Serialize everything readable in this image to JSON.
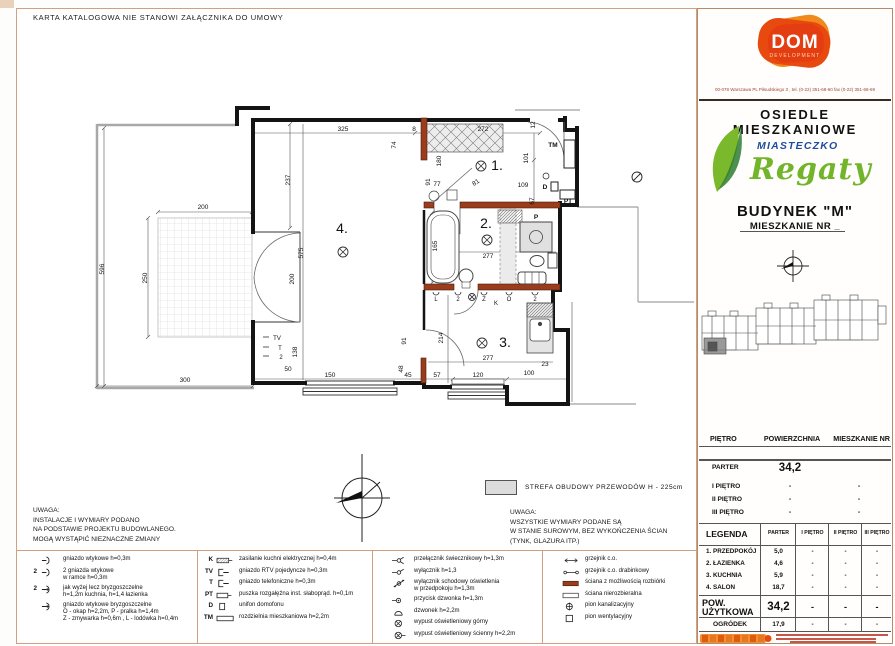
{
  "sheet": {
    "disclaimer": "KARTA  KATALOGOWA  NIE STANOWI  ZAŁĄCZNIKA DO UMOWY",
    "strefa_label": "STREFA  OBUDOWY  PRZEWODÓW  H - 225cm",
    "note_left": {
      "title": "UWAGA:",
      "lines": [
        "INSTALACJE I WYMIARY PODANO",
        "NA PODSTAWIE PROJEKTU BUDOWLANEGO.",
        "MOGĄ WYSTĄPIĆ NIEZNACZNE ZMIANY"
      ]
    },
    "note_right": {
      "title": "UWAGA:",
      "lines": [
        "WSZYSTKIE WYMIARY PODANE SĄ",
        "W STANIE SUROWYM, BEZ WYKOŃCZENIA ŚCIAN",
        "(TYNK, GLAZURA ITP.)"
      ]
    }
  },
  "plan": {
    "texts": [
      {
        "t": "325",
        "x": 343,
        "y": 131
      },
      {
        "t": "8",
        "x": 414,
        "y": 131
      },
      {
        "t": "74",
        "x": 396,
        "y": 145,
        "r": -90
      },
      {
        "t": "272",
        "x": 483,
        "y": 131
      },
      {
        "t": "12",
        "x": 535,
        "y": 125,
        "r": -90
      },
      {
        "t": "180",
        "x": 441,
        "y": 161,
        "r": -90
      },
      {
        "t": "101",
        "x": 528,
        "y": 158,
        "r": -90
      },
      {
        "t": "91",
        "x": 430,
        "y": 182,
        "r": -90
      },
      {
        "t": "77",
        "x": 437,
        "y": 186
      },
      {
        "t": "81",
        "x": 477,
        "y": 184,
        "r": -35
      },
      {
        "t": "109",
        "x": 523,
        "y": 187
      },
      {
        "t": "67",
        "x": 534,
        "y": 201,
        "r": -90
      },
      {
        "t": "237",
        "x": 290,
        "y": 180,
        "r": -90
      },
      {
        "t": "575",
        "x": 303,
        "y": 253,
        "r": -90
      },
      {
        "t": "200",
        "x": 294,
        "y": 279,
        "r": -90
      },
      {
        "t": "200",
        "x": 203,
        "y": 209
      },
      {
        "t": "250",
        "x": 147,
        "y": 278,
        "r": -90
      },
      {
        "t": "596",
        "x": 104,
        "y": 269,
        "r": -90
      },
      {
        "t": "300",
        "x": 185,
        "y": 382
      },
      {
        "t": "165",
        "x": 437,
        "y": 246,
        "r": -90
      },
      {
        "t": "277",
        "x": 488,
        "y": 258
      },
      {
        "t": "214",
        "x": 443,
        "y": 338,
        "r": -90
      },
      {
        "t": "91",
        "x": 406,
        "y": 341,
        "r": -90
      },
      {
        "t": "277",
        "x": 488,
        "y": 360
      },
      {
        "t": "48",
        "x": 403,
        "y": 369,
        "r": -90
      },
      {
        "t": "57",
        "x": 437,
        "y": 377
      },
      {
        "t": "120",
        "x": 478,
        "y": 377
      },
      {
        "t": "100",
        "x": 529,
        "y": 375
      },
      {
        "t": "23",
        "x": 545,
        "y": 366
      },
      {
        "t": "150",
        "x": 330,
        "y": 377
      },
      {
        "t": "45",
        "x": 408,
        "y": 377
      },
      {
        "t": "138",
        "x": 297,
        "y": 352,
        "r": -90
      },
      {
        "t": "50",
        "x": 288,
        "y": 371
      },
      {
        "t": "TM",
        "x": 553,
        "y": 147,
        "b": 1
      },
      {
        "t": "D",
        "x": 545,
        "y": 189,
        "b": 1
      },
      {
        "t": "PT",
        "x": 568,
        "y": 203,
        "b": 1
      },
      {
        "t": "P",
        "x": 536,
        "y": 219,
        "b": 1
      },
      {
        "t": "TV",
        "x": 277,
        "y": 340,
        "size": 6
      },
      {
        "t": "T",
        "x": 280,
        "y": 350,
        "size": 6
      },
      {
        "t": "2",
        "x": 281,
        "y": 359,
        "size": 6
      },
      {
        "t": "L",
        "x": 436,
        "y": 301,
        "size": 6
      },
      {
        "t": "2",
        "x": 458,
        "y": 301,
        "size": 6
      },
      {
        "t": "Z",
        "x": 484,
        "y": 301,
        "size": 6
      },
      {
        "t": "K",
        "x": 496,
        "y": 305,
        "size": 6
      },
      {
        "t": "O",
        "x": 509,
        "y": 301,
        "size": 6
      },
      {
        "t": "2",
        "x": 535,
        "y": 301,
        "size": 6
      },
      {
        "t": "4.",
        "x": 342,
        "y": 233,
        "size": 14,
        "n": "room-number-salon"
      },
      {
        "t": "1.",
        "x": 497,
        "y": 170,
        "size": 14,
        "n": "room-number-przedpokoj"
      },
      {
        "t": "2.",
        "x": 486,
        "y": 228,
        "size": 14,
        "n": "room-number-lazienka"
      },
      {
        "t": "3.",
        "x": 505,
        "y": 347,
        "size": 14,
        "n": "room-number-kuchnia"
      }
    ],
    "lights": [
      [
        343,
        252,
        5
      ],
      [
        481,
        166,
        5
      ],
      [
        487,
        240,
        5
      ],
      [
        482,
        343,
        5
      ],
      [
        472,
        297,
        3.5
      ]
    ]
  },
  "legend": {
    "col1": [
      {
        "icon": "socket",
        "pre": "",
        "lines": [
          "gniazdo wtykowe h=0,3m"
        ]
      },
      {
        "icon": "socket",
        "pre": "2",
        "lines": [
          "2 gniazda wtykowe",
          "w ramce h=0,3m"
        ]
      },
      {
        "icon": "socket-splash",
        "pre": "2",
        "lines": [
          "jak wyżej lecz bryzgoszczelne",
          "h=1,2m kuchnia, h=1,4 łazienka"
        ]
      },
      {
        "icon": "socket-splash",
        "pre": "",
        "lines": [
          "gniazdo wtykowe bryzgoszczelne",
          "O - okap h=2,2m, P - pralka h=1,4m",
          "Z - zmywarka h=0,6m , L - lodówka h=0,4m"
        ]
      }
    ],
    "col2": [
      {
        "icon": "kbox",
        "pre": "K",
        "lines": [
          "zasilanie kuchni elektrycznej h=0,4m"
        ]
      },
      {
        "icon": "jack",
        "pre": "TV",
        "lines": [
          "gniazdo RTV pojedyncze h=0,3m"
        ]
      },
      {
        "icon": "jack",
        "pre": "T",
        "lines": [
          "gniazdo telefoniczne h=0,3m"
        ]
      },
      {
        "icon": "ptbox",
        "pre": "PT",
        "lines": [
          "puszka rozgałęźna inst. słaboprąd. h=0,1m"
        ]
      },
      {
        "icon": "dbox",
        "pre": "D",
        "lines": [
          "unifon domofonu"
        ]
      },
      {
        "icon": "tmbox",
        "pre": "TM",
        "lines": [
          "rozdzielnia mieszkaniowa h=2,2m"
        ]
      }
    ],
    "col3": [
      {
        "icon": "sw-double",
        "pre": "",
        "lines": [
          "przełącznik świecznikowy h=1,3m"
        ]
      },
      {
        "icon": "sw",
        "pre": "",
        "lines": [
          "wyłącznik h=1,3"
        ]
      },
      {
        "icon": "sw-stair",
        "pre": "",
        "lines": [
          "wyłącznik schodowy oświetlenia",
          "w przedpokoju h=1,3m"
        ]
      },
      {
        "icon": "bell-btn",
        "pre": "",
        "lines": [
          "przycisk dzwonka h=1,3m"
        ]
      },
      {
        "icon": "bell",
        "pre": "",
        "lines": [
          "dzwonek h=2,2m"
        ]
      },
      {
        "icon": "light-top",
        "pre": "",
        "lines": [
          "wypust oświetleniowy górny"
        ]
      },
      {
        "icon": "light-wall",
        "pre": "",
        "lines": [
          "wypust oświetleniowy ścienny h=2,2m"
        ]
      }
    ],
    "col4": [
      {
        "icon": "rad",
        "pre": "",
        "lines": [
          "grzejnik c.o."
        ]
      },
      {
        "icon": "rad-ladder",
        "pre": "",
        "lines": [
          "grzejnik c.o. drabinkowy"
        ]
      },
      {
        "icon": "wall-brown",
        "pre": "",
        "lines": [
          "ściana z możliwością rozbiórki"
        ]
      },
      {
        "icon": "wall-white",
        "pre": "",
        "lines": [
          "ściana nierozbieralna"
        ]
      },
      {
        "icon": "pion-k",
        "pre": "",
        "lines": [
          "pion kanalizacyjny"
        ]
      },
      {
        "icon": "pion-w",
        "pre": "",
        "lines": [
          "pion wentylacyjny"
        ]
      }
    ]
  },
  "panel": {
    "logo": {
      "name": "DOM",
      "sub": "DEVELOPMENT"
    },
    "address": "00-078 Warszawa PL Piłsudskiego 3 , tel. (0-22) 351-68-60 fax (0-22) 351-68-69",
    "estate": "OSIEDLE  MIESZKANIOWE",
    "brand_top": "MIASTECZKO",
    "brand_name": "Regaty",
    "building": "BUDYNEK  \"M\"",
    "apartment": "MIESZKANIE  NR _",
    "floor_table": {
      "headers": [
        "PIĘTRO",
        "POWIERZCHNIA",
        "MIESZKANIE NR"
      ],
      "rows": [
        [
          "PARTER",
          "34,2",
          ""
        ],
        [
          "I  PIĘTRO",
          "-",
          "-"
        ],
        [
          "II  PIĘTRO",
          "-",
          "-"
        ],
        [
          "III  PIĘTRO",
          "-",
          "-"
        ]
      ]
    },
    "legend_table": {
      "col0": "LEGENDA",
      "cols": [
        "PARTER",
        "I PIĘTRO",
        "II PIĘTRO",
        "III PIĘTRO"
      ],
      "rows": [
        [
          "1.  PRZEDPOKÓJ",
          "5,0",
          "-",
          "-",
          "-"
        ],
        [
          "2.  ŁAZIENKA",
          "4,6",
          "-",
          "-",
          "-"
        ],
        [
          "3.  KUCHNIA",
          "5,9",
          "-",
          "-",
          "-"
        ],
        [
          "4.  SALON",
          "18,7",
          "-",
          "-",
          "-"
        ]
      ],
      "total_label1": "POW.",
      "total_label2": "UŻYTKOWA",
      "total_row": [
        "34,2",
        "-",
        "-",
        "-"
      ],
      "garden_label": "OGRÓDEK",
      "garden_row": [
        "17,9",
        "-",
        "-",
        "-"
      ]
    }
  }
}
